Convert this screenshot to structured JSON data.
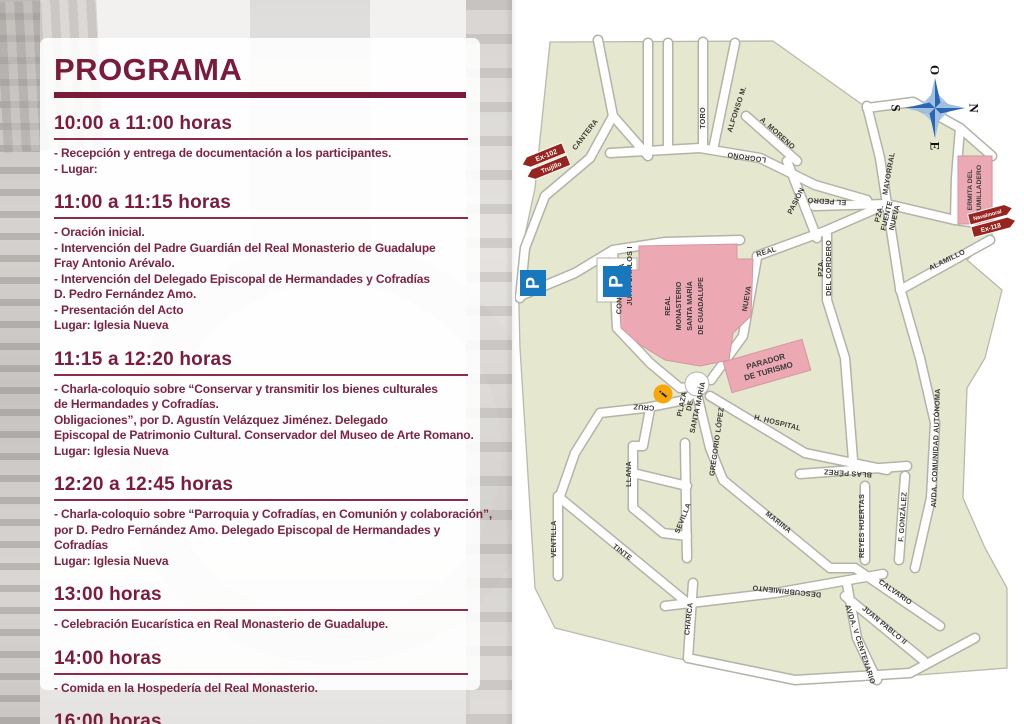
{
  "program": {
    "title": "PROGRAMA",
    "sections": [
      {
        "time": "10:00 a 11:00 horas",
        "lines": [
          "- Recepción y entrega de documentación a los participantes.",
          "- Lugar:"
        ]
      },
      {
        "time": "11:00 a 11:15 horas",
        "lines": [
          "- Oración inicial.",
          "- Intervención del Padre Guardián del Real Monasterio de Guadalupe",
          "Fray Antonio Arévalo.",
          "- Intervención del Delegado Episcopal de Hermandades y Cofradías",
          "D. Pedro Fernández Amo.",
          "- Presentación del Acto",
          "Lugar: Iglesia Nueva"
        ]
      },
      {
        "time": "11:15 a 12:20 horas",
        "lines": [
          "-  Charla-coloquio sobre “Conservar y transmitir los bienes culturales",
          "de Hermandades y Cofradías.",
          "Obligaciones”, por D. Agustín Velázquez Jiménez. Delegado",
          "Episcopal de Patrimonio Cultural. Conservador del Museo de Arte Romano.",
          "Lugar: Iglesia Nueva"
        ]
      },
      {
        "time": "12:20 a 12:45 horas",
        "lines": [
          "-  Charla-coloquio sobre “Parroquia y Cofradías, en Comunión y colaboración”,",
          "por D. Pedro Fernández Amo. Delegado Episcopal de Hermandades y",
          "Cofradías",
          "Lugar: Iglesia Nueva"
        ]
      },
      {
        "time": "13:00 horas",
        "lines": [
          "-  Celebración Eucarística en Real Monasterio de Guadalupe."
        ]
      },
      {
        "time": "14:00 horas",
        "lines": [
          "-  Comida en la Hospedería del Real Monasterio."
        ]
      },
      {
        "time": "16:00 horas",
        "lines": [
          "-  Acto Mariano."
        ]
      }
    ]
  },
  "map": {
    "compass": {
      "top": "O",
      "right": "N",
      "left": "S",
      "bottom": "E"
    },
    "signs": {
      "west": {
        "line1": "Ex-102",
        "line2": "Trujillo"
      },
      "east": {
        "line1": "Navalmoral",
        "line2": "Ex-118"
      }
    },
    "parking_label": "P",
    "info_label": "i",
    "buildings": {
      "monastery": {
        "l1": "REAL",
        "l2": "MONASTERIO",
        "l3": "SANTA MARÍA",
        "l4": "DE GUADALUPE"
      },
      "parador": {
        "l1": "PARADOR",
        "l2": "DE TURISMO"
      },
      "ermita": {
        "l1": "ERMITA DEL",
        "l2": "HUMILLADERO"
      }
    },
    "plazas": {
      "juan_carlos": {
        "l1": "PLAZA",
        "l2": "JUAN CARLOS I"
      },
      "santa_maria": {
        "l1": "PLAZA",
        "l2": "DE",
        "l3": "SANTA MARÍA"
      },
      "fuente_nueva": {
        "l1": "PZA.",
        "l2": "FUENTE",
        "l3": "NUEVA"
      },
      "cordero": {
        "l1": "PZA.",
        "l2": "DEL CORDERO"
      }
    },
    "streets": [
      "CANTERA",
      "TORO",
      "ALFONSO M.",
      "A. MORENO",
      "LOGROÑO",
      "PASIÓN",
      "EL PEDRO",
      "MAYORRAL",
      "ALAMILLO",
      "REAL",
      "NUEVA",
      "CONVENTO",
      "AVDA. COMUNIDAD AUTÓNOMA",
      "H. HOSPITAL",
      "CRUZ",
      "GREGORIO LÓPEZ",
      "MARINA",
      "BLAS PÉREZ",
      "REYES HUERTAS",
      "F. GONZÁLEZ",
      "SEVILLA",
      "LLANA",
      "TINTE",
      "VENTILLA",
      "CHARCA",
      "DESCUBRIMIENTO",
      "CALVARIO",
      "JUAN PABLO II",
      "AVDA. V CENTENARIO"
    ]
  },
  "colors": {
    "maroon": "#7a1b39",
    "map_green": "#e5e7ce",
    "building_pink": "#eca9b4",
    "parking_blue": "#1878be",
    "sign_red": "#97241f",
    "info_orange": "#f7a70a",
    "compass_blue": "#2b67b0"
  }
}
